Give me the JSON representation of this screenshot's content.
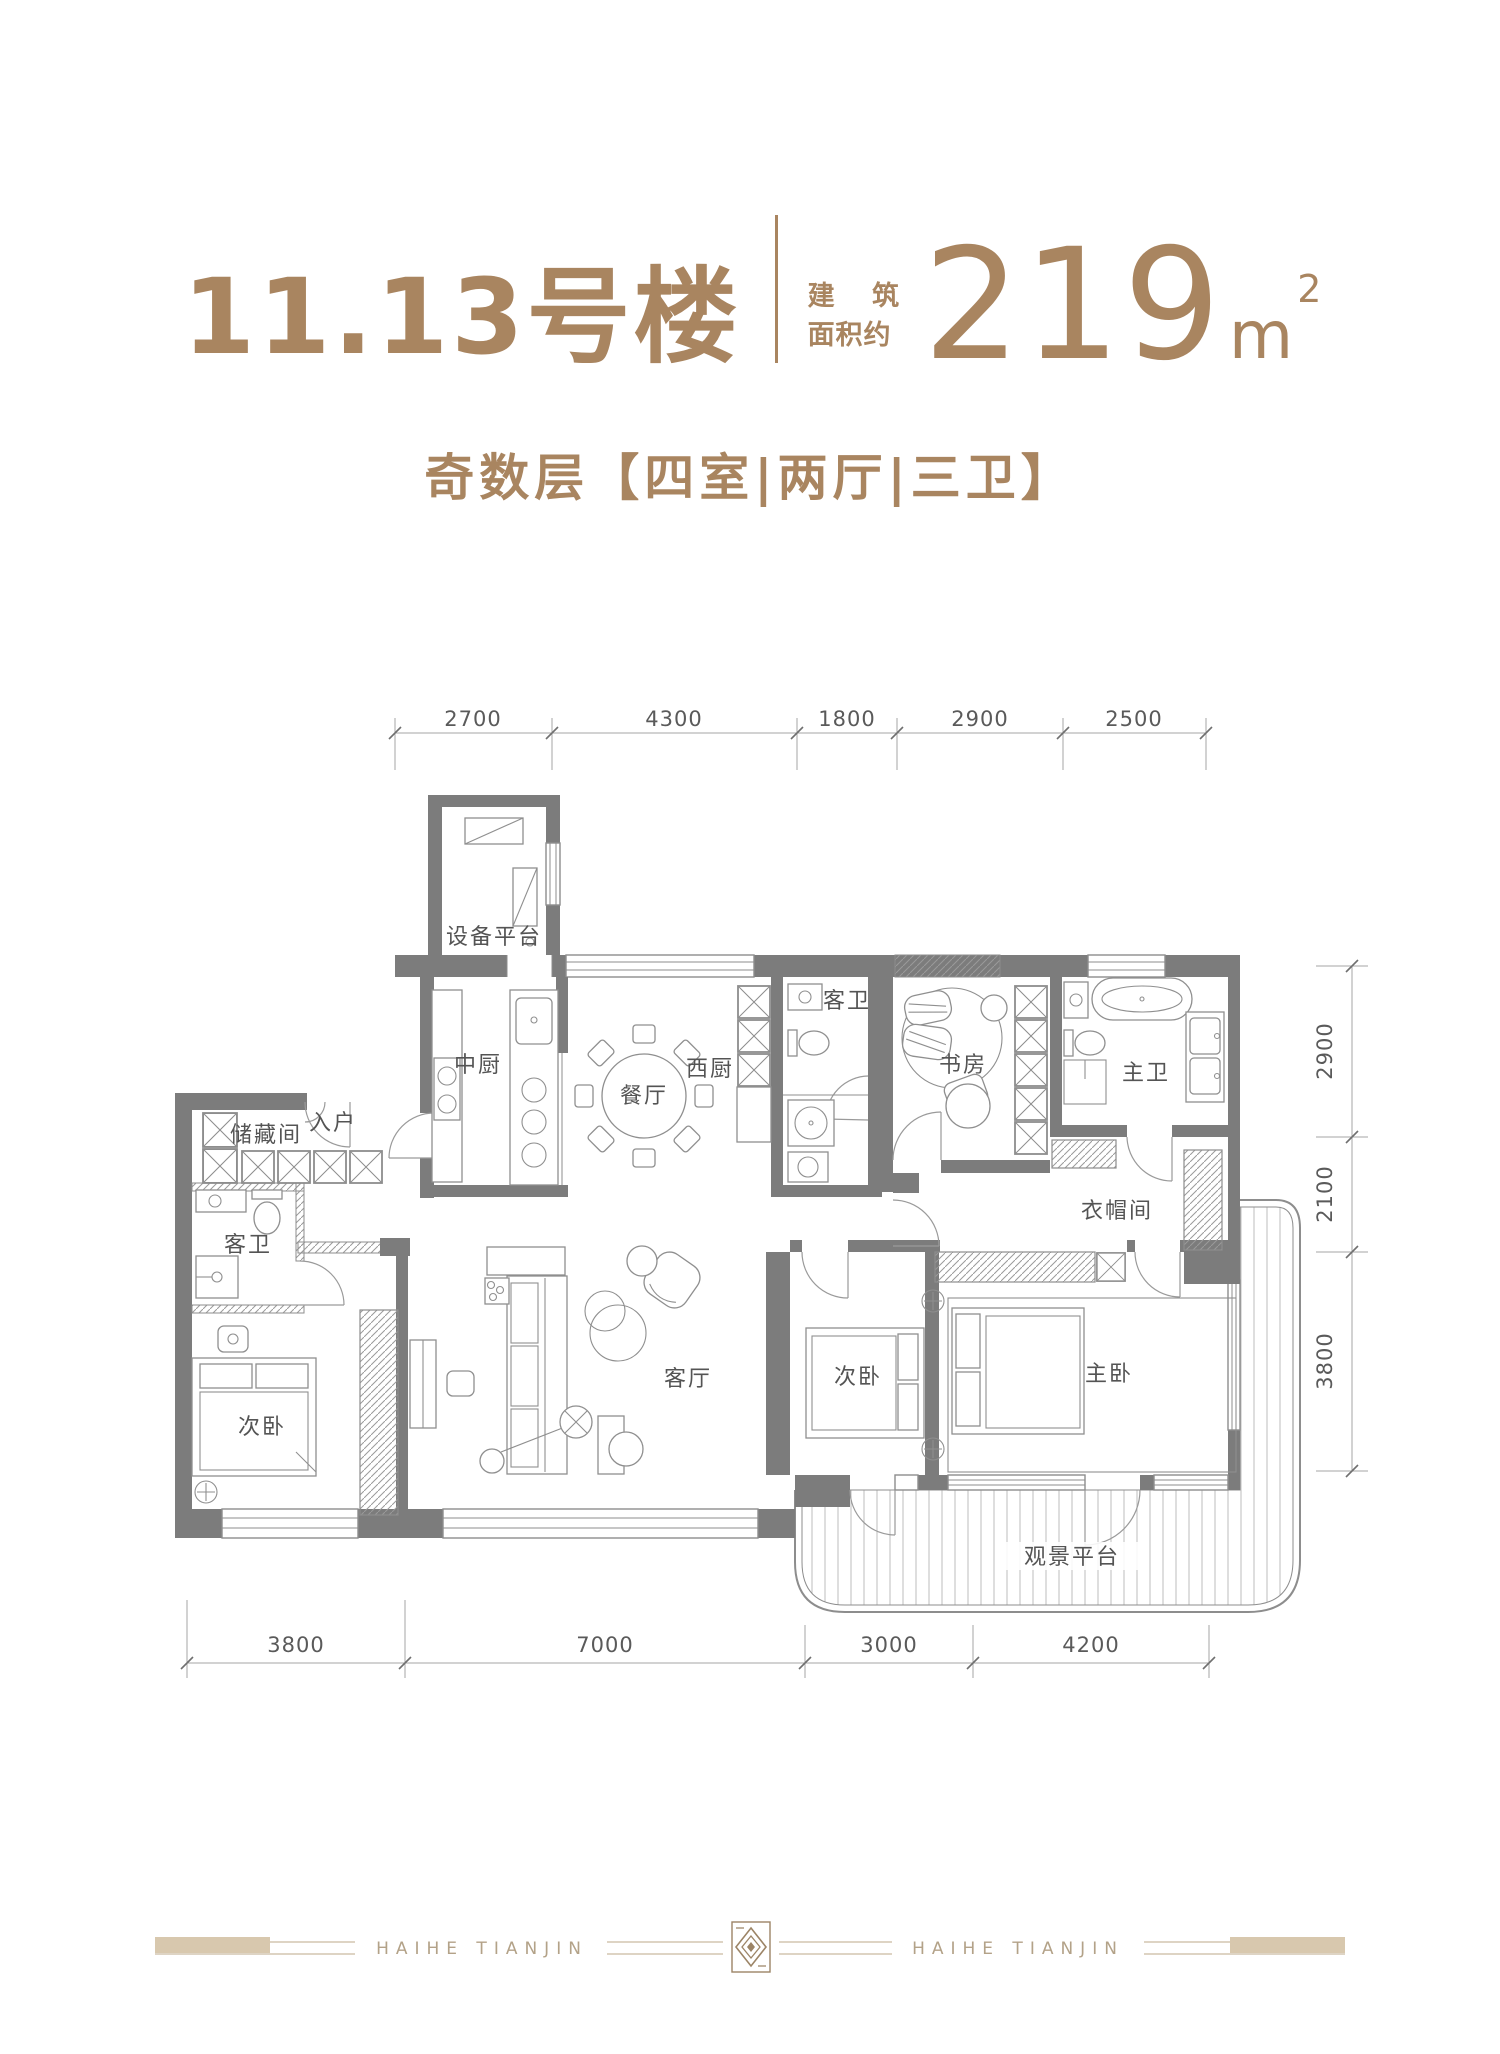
{
  "header": {
    "building_title": "11.13号楼",
    "area_label_1": "建 筑",
    "area_label_2": "面积约",
    "area_value": "219",
    "area_unit": "m",
    "area_exponent": "2",
    "subtitle": "奇数层【四室|两厅|三卫】"
  },
  "rooms": {
    "equipment": "设备平台",
    "kitchen_cn": "中厨",
    "entry": "入户",
    "storage": "储藏间",
    "dining": "餐厅",
    "kitchen_west": "西厨",
    "guest_bath_top": "客卫",
    "study": "书房",
    "master_bath": "主卫",
    "cloakroom": "衣帽间",
    "guest_bath_left": "客卫",
    "bedroom_left": "次卧",
    "living": "客厅",
    "bedroom_mid": "次卧",
    "master_bedroom": "主卧",
    "view_deck": "观景平台"
  },
  "dimensions": {
    "top": [
      "2700",
      "4300",
      "1800",
      "2900",
      "2500"
    ],
    "right": [
      "2900",
      "2100",
      "3800"
    ],
    "bottom": [
      "3800",
      "7000",
      "3000",
      "4200"
    ]
  },
  "footer": {
    "brand": "HAIHE TIANJIN"
  },
  "colors": {
    "accent_brown": "#A98560",
    "wall_gray": "#7c7c7c",
    "footer_beige": "#d8c8ae"
  }
}
